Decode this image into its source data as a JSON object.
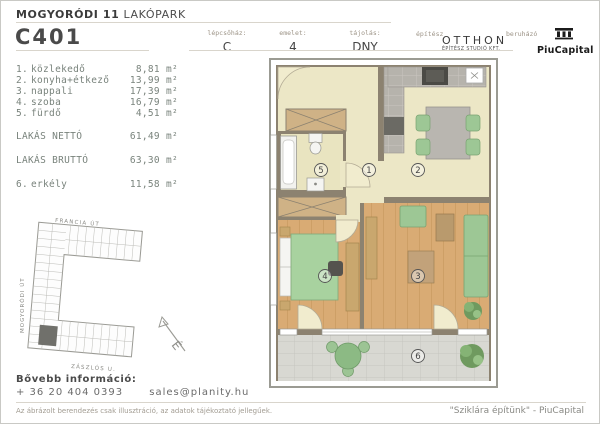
{
  "header": {
    "project_title_bold": "MOGYORÓDI 11",
    "project_title_regular": "LAKÓPARK",
    "unit_code": "C401",
    "info_fields": [
      {
        "label": "lépcsőház:",
        "value": "C"
      },
      {
        "label": "emelet:",
        "value": "4"
      },
      {
        "label": "tájolás:",
        "value": "DNY"
      }
    ],
    "architect": {
      "label": "építész",
      "name": "OTTHON",
      "subtitle": "ÉPÍTÉSZ STUDIÓ KFT."
    },
    "developer": {
      "label": "beruházó",
      "name": "PiuCapital"
    }
  },
  "area_table": {
    "rooms": [
      {
        "index": "1.",
        "name": "közlekedő",
        "value": "8,81",
        "unit": "m²"
      },
      {
        "index": "2.",
        "name": "konyha+étkező",
        "value": "13,99",
        "unit": "m²"
      },
      {
        "index": "3.",
        "name": "nappali",
        "value": "17,39",
        "unit": "m²"
      },
      {
        "index": "4.",
        "name": "szoba",
        "value": "16,79",
        "unit": "m²"
      },
      {
        "index": "5.",
        "name": "fürdő",
        "value": "4,51",
        "unit": "m²"
      }
    ],
    "totals": [
      {
        "label": "LAKÁS NETTÓ",
        "value": "61,49",
        "unit": "m²"
      },
      {
        "label": "LAKÁS BRUTTÓ",
        "value": "63,30",
        "unit": "m²"
      }
    ],
    "balcony_row": {
      "index": "6.",
      "name": "erkély",
      "value": "11,58",
      "unit": "m²"
    }
  },
  "floor_plan": {
    "room_labels": [
      {
        "num": "5"
      },
      {
        "num": "1"
      },
      {
        "num": "2"
      },
      {
        "num": "4"
      },
      {
        "num": "3"
      },
      {
        "num": "6"
      }
    ]
  },
  "site_plan": {
    "streets": {
      "top": "FRANCIA ÚT",
      "left": "MOGYORÓDI ÚT",
      "bottom": "ZÁSZLÓS U."
    },
    "north_label": "É"
  },
  "footer": {
    "info_label": "Bővebb információ:",
    "phone": "+ 36 20 404 0393",
    "email": "sales@planity.hu",
    "disclaimer": "Az ábrázolt berendezés csak illusztráció, az adatok tájékoztató jellegűek.",
    "slogan": "\"Sziklára építünk\" - PiuCapital"
  },
  "colors": {
    "floor_light": "#ece7c6",
    "floor_wood": "#d9ab74",
    "balcony_floor": "#d8d8d2",
    "wall": "#8c8270",
    "furniture_green": "#9dc795",
    "counter_gray": "#b6b3ac",
    "highlight_unit": "#70706b"
  }
}
